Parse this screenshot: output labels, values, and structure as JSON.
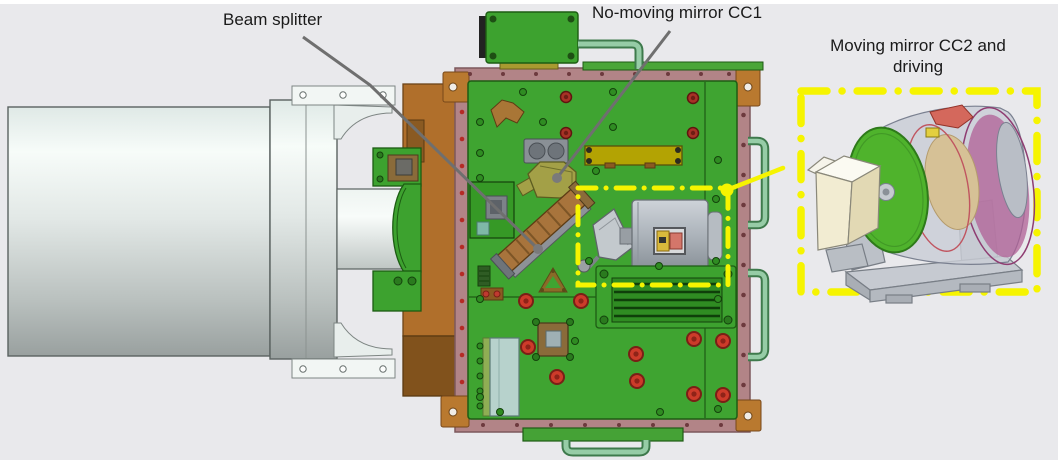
{
  "annotations": {
    "beam_splitter": {
      "label": "Beam splitter"
    },
    "fixed_mirror": {
      "label": "No-moving mirror CC1"
    },
    "moving_mirror": {
      "label_line1": "Moving mirror CC2 and",
      "label_line2": "driving"
    }
  },
  "colors": {
    "page-bg": "#ffffff",
    "figure-bg": "#e9e9ec",
    "panel-green": "#3fa431",
    "panel-green-dark": "#1e5c14",
    "frame-mauve": "#b28487",
    "frame-mauve-dark": "#7c585c",
    "copper-brown": "#b06f2b",
    "copper-brown-dark": "#6d4417",
    "highlight-yellow": "#f6f400",
    "leader-gray": "#6f6f6f",
    "label-text": "#1a1a1a",
    "handle-green": "#96cca6",
    "handle-green-dark": "#3e7a4c",
    "screw-red": "#cd3b2a",
    "mirror-disc-green": "#4fb32c",
    "olive-mount": "#a3a047",
    "motor-gray": "#aeb5bc",
    "cream-mirror": "#f2ecd2",
    "magenta-coil": "#b05f95",
    "tan-core": "#d6c196"
  }
}
